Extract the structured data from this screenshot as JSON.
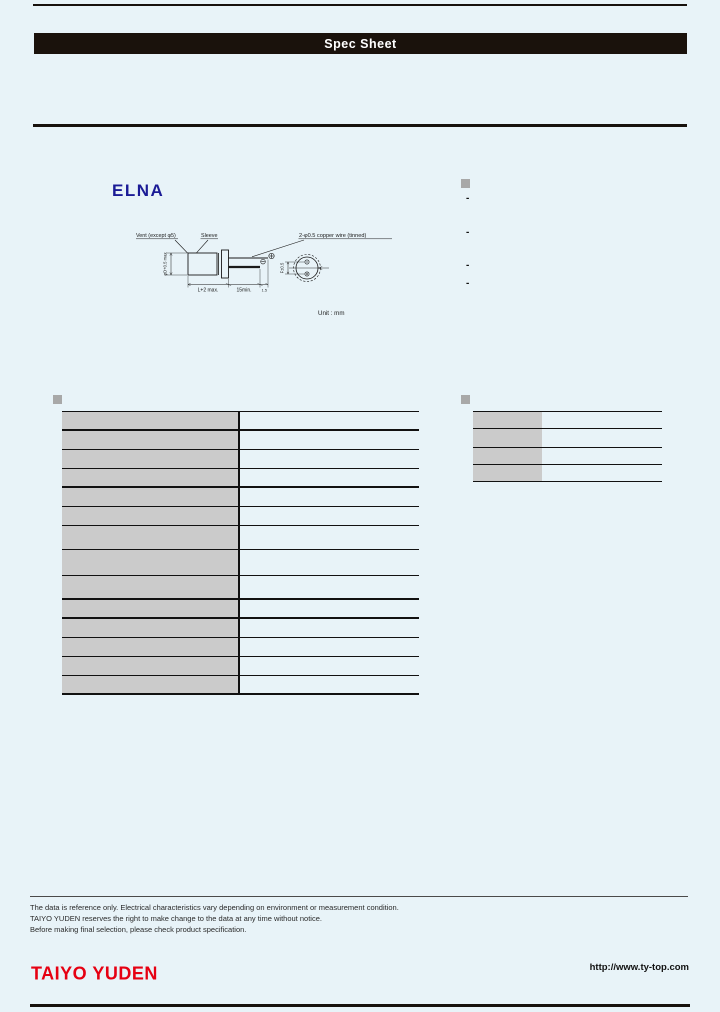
{
  "colors": {
    "page_bg": "#e8f3f8",
    "title_bar_bg": "#1a120c",
    "title_text": "#ffffff",
    "elna_blue": "#1b1b96",
    "taiyo_red": "#e60012",
    "cell_gray": "#cbcbcb",
    "bullet_gray": "#a8a8a8",
    "line_black": "#17110d"
  },
  "title_bar": {
    "title": "Spec Sheet"
  },
  "brand": {
    "name": "ELNA"
  },
  "diagram": {
    "label_vent": "Vent (except φ5)",
    "label_sleeve": "Sleeve",
    "label_wire": "2-φ0.5 copper wire (tinned)",
    "dim_diameter": "φD+0.5 max",
    "dim_length": "L+2 max.",
    "dim_lead": "15min.",
    "dim_tip": "1.5",
    "dim_pitch": "F±0.5",
    "polarity_plus": "+",
    "polarity_minus": "−",
    "unit_note": "Unit : mm"
  },
  "features": {
    "bullet": "",
    "items": [
      "-",
      "-",
      "-",
      "-"
    ]
  },
  "spec_table": {
    "bullet": "",
    "rows": [
      [
        "",
        ""
      ],
      [
        "",
        ""
      ],
      [
        "",
        ""
      ],
      [
        "",
        ""
      ],
      [
        "",
        ""
      ],
      [
        "",
        ""
      ],
      [
        "",
        ""
      ],
      [
        "",
        ""
      ],
      [
        "",
        ""
      ],
      [
        "",
        ""
      ],
      [
        "",
        ""
      ],
      [
        "",
        ""
      ],
      [
        "",
        ""
      ],
      [
        "",
        ""
      ]
    ]
  },
  "mini_table": {
    "bullet": "",
    "rows": [
      [
        "",
        ""
      ],
      [
        "",
        ""
      ],
      [
        "",
        ""
      ],
      [
        "",
        ""
      ]
    ]
  },
  "notes": {
    "lines": [
      "The data is reference only. Electrical characteristics vary depending on environment or measurement condition.",
      "TAIYO YUDEN reserves the right to make change to the data at any time without notice.",
      "Before making final selection, please check product specification."
    ]
  },
  "footer": {
    "logo": "TAIYO YUDEN",
    "url": "http://www.ty-top.com"
  }
}
